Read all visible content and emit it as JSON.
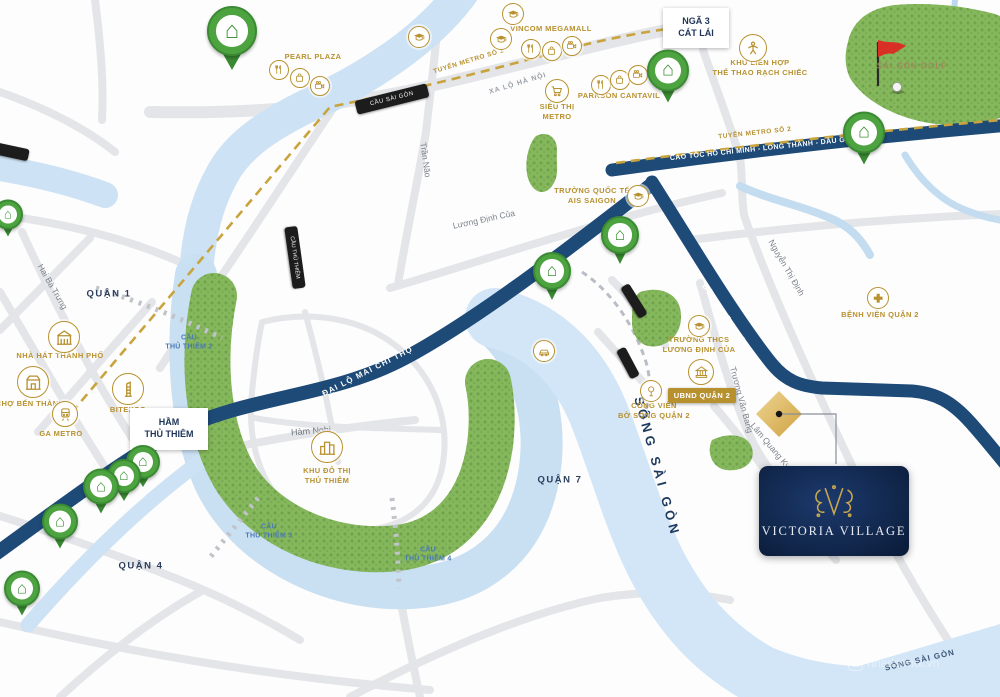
{
  "project": {
    "name": "VICTORIA VILLAGE"
  },
  "districts": {
    "q1": "QUẬN 1",
    "q4": "QUẬN 4",
    "q7": "QUẬN 7"
  },
  "rivers": {
    "saigon": "SÔNG SÀI GÒN",
    "saigon_corner": "SÔNG SÀI GÒN"
  },
  "roads": {
    "mai_chi_tho": "ĐẠI LỘ MAI CHÍ THỌ",
    "dong_van_cong": "ĐỒNG VĂN CỐNG",
    "cao_toc": "CAO TỐC HỒ CHÍ MINH - LONG THÀNH - DẦU GIÂY",
    "xa_lo_ha_noi": "XA LỘ HÀ NỘI",
    "ham_nghi": "Hàm Nghi",
    "hai_ba_trung": "Hai Bà Trưng",
    "tran_nao": "Trần Não",
    "luong_dinh_cua": "Lương Định Của",
    "nguyen_thi_dinh": "Nguyễn Thị Định",
    "truong_van_bang": "Trương Văn Bang",
    "lam_quang_ky": "Lâm Quang Ky"
  },
  "metro": {
    "line1": "TUYẾN METRO SỐ 1",
    "line2": "TUYẾN METRO SỐ 2"
  },
  "bridges": {
    "cau_sai_gon": "CẦU SÀI GÒN",
    "cau_thu_thiem": "CẦU THỦ THIÊM",
    "cau_thu_thiem_2": "CẦU\nTHỦ THIÊM 2",
    "cau_thu_thiem_3": "CẦU\nTHỦ THIÊM 3",
    "cau_thu_thiem_4": "CẦU\nTHỦ THIÊM 4",
    "ham_thu_thiem": "HẦM\nTHỦ THIÊM",
    "nga_3_cat_lai": "NGÃ 3\nCÁT LÁI"
  },
  "landmarks": {
    "pearl_plaza": "PEARL PLAZA",
    "vincom_megamall": "VINCOM MEGAMALL",
    "parkson_cantavil": "PARKSON CANTAVIL",
    "sieu_thi_metro": "SIÊU THỊ\nMETRO",
    "khu_lien_hop": "KHU LIÊN HỢP\nTHỂ THAO RẠCH CHIẾC",
    "sai_gon_golf": "SÀI GÒN GOLF",
    "truong_quoc_te_ais": "TRƯỜNG QUỐC TẾ\nAIS SAIGON",
    "nha_hat_thanh_pho": "NHÀ HÁT THÀNH PHỐ",
    "cho_ben_thanh": "CHỢ BẾN THÀNH",
    "bitexco": "BITEXCO",
    "ga_metro": "GA METRO",
    "khu_do_thi_thu_thiem": "KHU ĐÔ THỊ\nTHỦ THIÊM",
    "truong_thcs": "TRƯỜNG THCS\nLƯƠNG ĐỊNH CỦA",
    "ubnd_quan_2": "UBND QUẬN 2",
    "cong_vien_bo_song": "CÔNG VIÊN\nBỜ SÔNG QUẬN 2",
    "benh_vien_quan_2": "BỆNH VIỆN QUẬN 2"
  },
  "watermark": "nhadatmoi.vn",
  "colors": {
    "navy": "#1d4a77",
    "gold": "#b8912f",
    "river": "#cde2f4",
    "park": "#82b558",
    "pin_green": "#4ca33f",
    "accent_red": "#d93025"
  }
}
